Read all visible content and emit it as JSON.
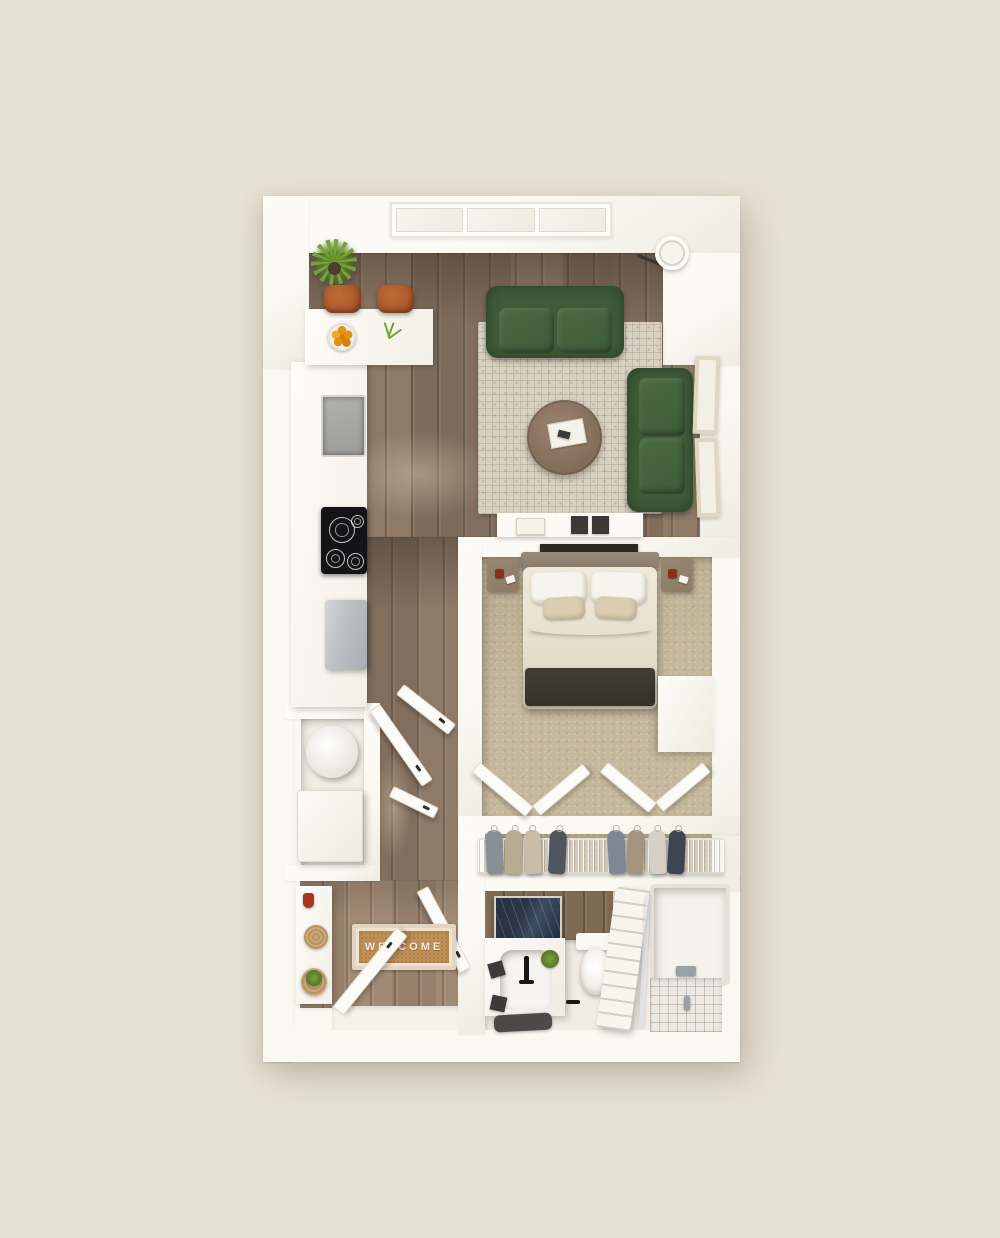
{
  "scene": {
    "description": "3D top-down floor plan render of a studio apartment",
    "welcome_mat_text": "WELCOME"
  },
  "colors": {
    "bg": "#e7e1d4",
    "wall": "#fbf8f2",
    "wood_floor": "#8d7a68",
    "entry_wood": "#a08a75",
    "bedroom_carpet": "#c6b89c",
    "closet_carpet": "#b3a488",
    "bath_floor": "#f1ede4",
    "bath_wood_wall": "#7f6b54",
    "rug": "#d8d0c1",
    "sofa_green": "#3f5c39",
    "sofa_green_light": "#4a6a41",
    "coffee_table": "#8b7562",
    "stool": "#a9572a",
    "orange": "#e69012",
    "plant": "#74a236",
    "bed_linen": "#e8e1d0",
    "pillow_white": "#f7f4ed",
    "pillow_tan": "#d9cdb2",
    "bed_throw": "#37312a",
    "headboard": "#8b7f6f",
    "nightstand": "#8c7a66",
    "deco_dark": "#2c2824",
    "cooktop": "#141417",
    "sink_steel": "#9b9b97",
    "fridge_steel": "#bcbfc2",
    "mirror_marble": "#2b3648",
    "mat": "#c09057",
    "mat_text_color": "#f2e9d8",
    "door": "#fdfbf7",
    "towel_white": "#f8f5ee",
    "tile": "#ebe9e2",
    "garment_1": "#8a8f96",
    "garment_2": "#b9aa92",
    "garment_3": "#c9bda8",
    "garment_4": "#4e555f",
    "garment_5": "#7d8795",
    "garment_6": "#a39480",
    "garment_7": "#d6cfc4",
    "garment_8": "#3e4450"
  }
}
